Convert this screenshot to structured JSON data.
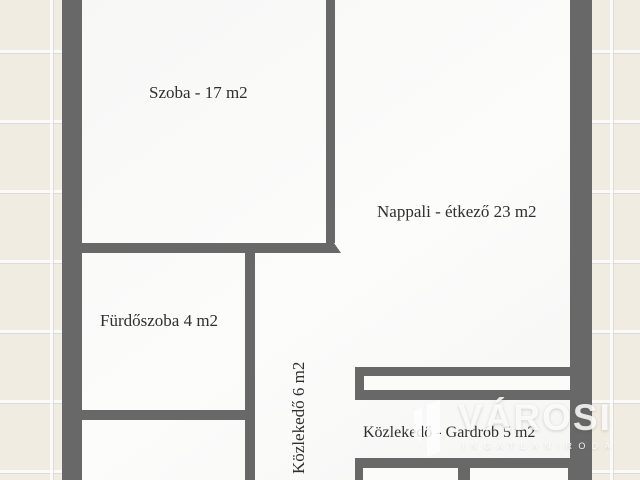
{
  "plan": {
    "rooms": [
      {
        "name": "szoba",
        "label": "Szoba - 17 m2"
      },
      {
        "name": "nappali-etkezo",
        "label": "Nappali - étkező 23 m2"
      },
      {
        "name": "furdoszoba",
        "label": "Fürdőszoba 4 m2"
      },
      {
        "name": "kozlekedo",
        "label": "Közlekedő 6 m2",
        "orientation": "vertical-bottom-to-top"
      },
      {
        "name": "kozlekedo-gardrob",
        "label": "Közlekedő - Gardrób 5 m2"
      }
    ]
  },
  "watermark": {
    "brand": "VÁROSI",
    "subtitle": "INGATLANIRODA",
    "logo_icon": "varosi-building-logo"
  },
  "colors": {
    "wall": "#686868",
    "floor": "#fafaf9",
    "background_tile": "#f1ece2",
    "label_text": "#2f2f2f",
    "watermark": "#ffffff"
  }
}
